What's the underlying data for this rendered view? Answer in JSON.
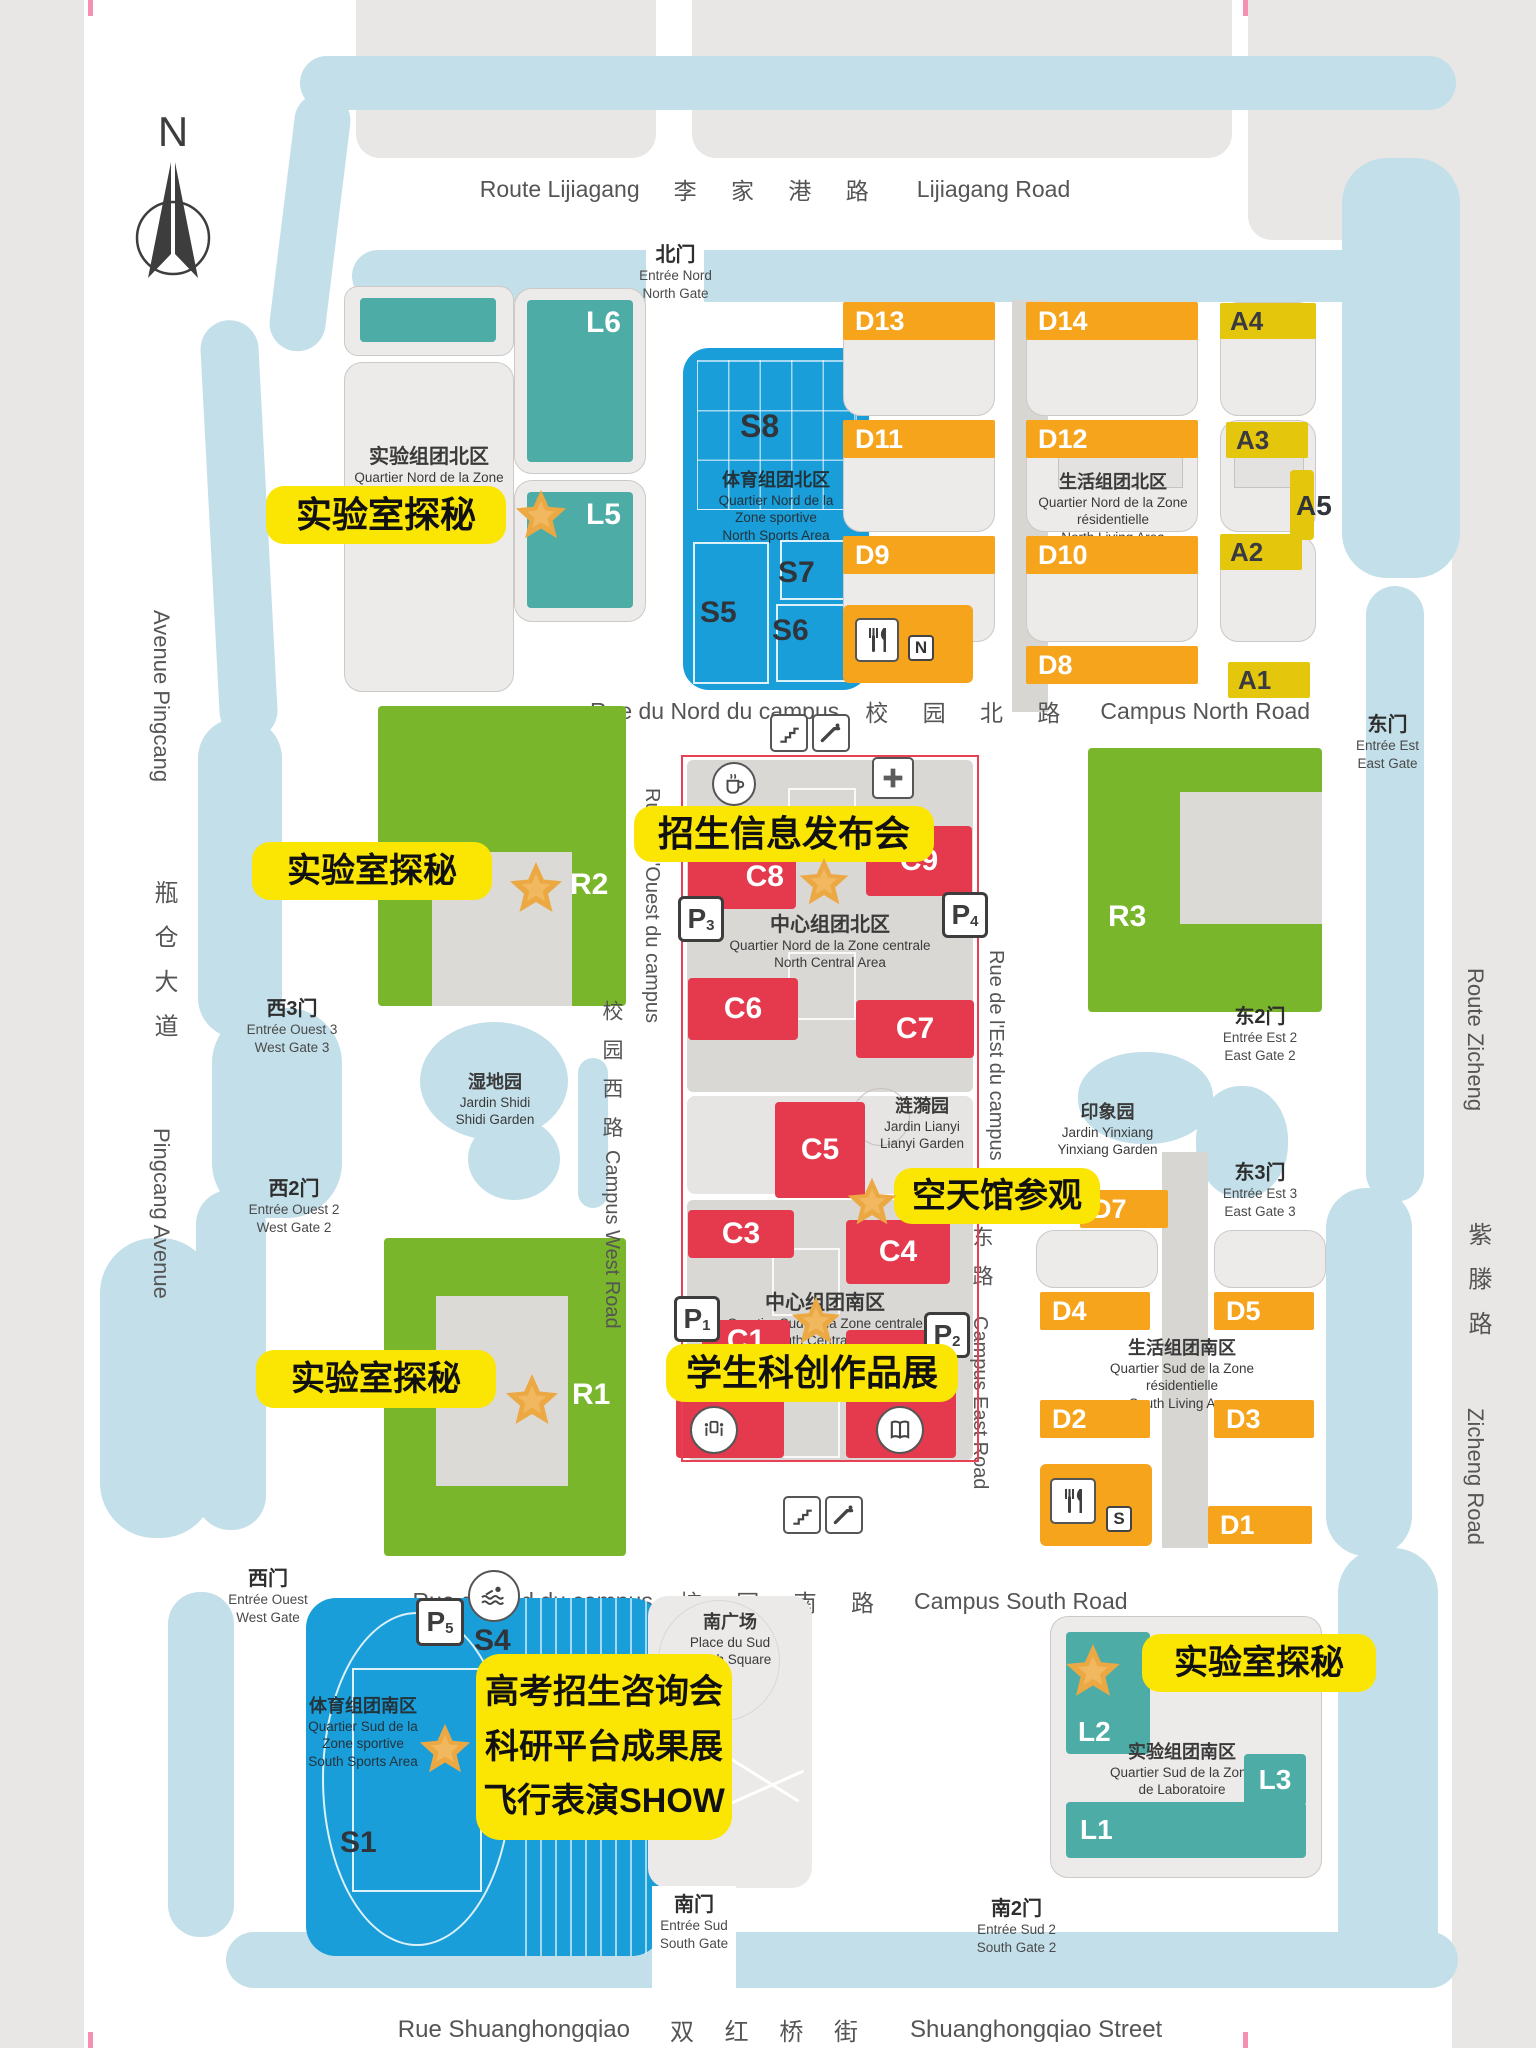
{
  "compass": {
    "label": "N"
  },
  "colors": {
    "water": "#c3dfe9",
    "sports_blue": "#1a9ed9",
    "lab_teal": "#4dada6",
    "residence_orange": "#f5a41c",
    "amenity_yellow": "#e4c60d",
    "central_red": "#e53a4e",
    "academic_green": "#79b62b",
    "event_yellow": "#fbe503",
    "star_orange": "#eca843"
  },
  "roads": {
    "lijiagang": {
      "fr": "Route Lijiagang",
      "zh": "李 家 港 路",
      "en": "Lijiagang Road"
    },
    "pingcang": {
      "fr": "Avenue Pingcang",
      "zh": "瓶仓大道",
      "en": "Pingcang Avenue"
    },
    "zicheng": {
      "fr": "Route Zicheng",
      "zh": "紫滕路",
      "en": "Zicheng Road"
    },
    "shuanghongqiao": {
      "fr": "Rue Shuanghongqiao",
      "zh": "双 红 桥 街",
      "en": "Shuanghongqiao Street"
    },
    "campus_north": {
      "fr": "Rue du Nord du campus",
      "zh": "校 园 北 路",
      "en": "Campus North Road"
    },
    "campus_south": {
      "fr": "Rue du Sud du campus",
      "zh": "校 园 南 路",
      "en": "Campus South Road"
    },
    "campus_west": {
      "fr": "Rue de l'Ouest du campus",
      "zh": "校园西路",
      "en": "Campus West Road"
    },
    "campus_east": {
      "fr": "Rue de l'Est du campus",
      "zh": "东路",
      "en": "Campus East Road"
    }
  },
  "gates": {
    "north": {
      "zh": "北门",
      "fr": "Entrée Nord",
      "en": "North Gate"
    },
    "east": {
      "zh": "东门",
      "fr": "Entrée Est",
      "en": "East Gate"
    },
    "east2": {
      "zh": "东2门",
      "fr": "Entrée Est 2",
      "en": "East Gate 2"
    },
    "east3": {
      "zh": "东3门",
      "fr": "Entrée Est 3",
      "en": "East Gate 3"
    },
    "west3": {
      "zh": "西3门",
      "fr": "Entrée Ouest 3",
      "en": "West Gate 3"
    },
    "west2": {
      "zh": "西2门",
      "fr": "Entrée Ouest 2",
      "en": "West Gate 2"
    },
    "west": {
      "zh": "西门",
      "fr": "Entrée Ouest",
      "en": "West Gate"
    },
    "south": {
      "zh": "南门",
      "fr": "Entrée Sud",
      "en": "South Gate"
    },
    "south2": {
      "zh": "南2门",
      "fr": "Entrée Sud 2",
      "en": "South Gate 2"
    }
  },
  "zones": {
    "lab_north": {
      "zh": "实验组团北区",
      "fr1": "Quartier Nord de la Zone",
      "fr2": "de Laboratoire"
    },
    "sports_north": {
      "zh": "体育组团北区",
      "fr1": "Quartier Nord de la",
      "fr2": "Zone sportive",
      "en": "North Sports Area"
    },
    "living_north": {
      "zh": "生活组团北区",
      "fr1": "Quartier Nord de la Zone",
      "fr2": "résidentielle",
      "en": "North Living Area"
    },
    "central_north": {
      "zh": "中心组团北区",
      "fr": "Quartier Nord de la Zone centrale",
      "en": "North Central Area"
    },
    "central_south": {
      "zh": "中心组团南区",
      "fr": "Quartier Sud de la Zone centrale",
      "en": "South Central Area"
    },
    "living_south": {
      "zh": "生活组团南区",
      "fr1": "Quartier Sud de la Zone",
      "fr2": "résidentielle",
      "en": "South Living Area"
    },
    "sports_south": {
      "zh": "体育组团南区",
      "fr1": "Quartier Sud de la",
      "fr2": "Zone sportive",
      "en": "South Sports Area"
    },
    "lab_south": {
      "zh": "实验组团南区",
      "fr1": "Quartier Sud de la Zone",
      "fr2": "de Laboratoire",
      "en": "South Laboratory Area"
    },
    "shidi": {
      "zh": "湿地园",
      "fr": "Jardin Shidi",
      "en": "Shidi Garden"
    },
    "lianyi": {
      "zh": "涟漪园",
      "fr": "Jardin Lianyi",
      "en": "Lianyi Garden"
    },
    "yinxiang": {
      "zh": "印象园",
      "fr": "Jardin Yinxiang",
      "en": "Yinxiang Garden"
    },
    "south_square": {
      "zh": "南广场",
      "fr": "Place du Sud",
      "en": "South Square"
    }
  },
  "buildings": {
    "L1": "L1",
    "L2": "L2",
    "L3": "L3",
    "L5": "L5",
    "L6": "L6",
    "S1": "S1",
    "S4": "S4",
    "S5": "S5",
    "S6": "S6",
    "S7": "S7",
    "S8": "S8",
    "A1": "A1",
    "A2": "A2",
    "A3": "A3",
    "A4": "A4",
    "A5": "A5",
    "C1": "C1",
    "C3": "C3",
    "C4": "C4",
    "C5": "C5",
    "C6": "C6",
    "C7": "C7",
    "C8": "C8",
    "C9": "C9",
    "D1": "D1",
    "D2": "D2",
    "D3": "D3",
    "D4": "D4",
    "D5": "D5",
    "D7": "D7",
    "D8": "D8",
    "D9": "D9",
    "D10": "D10",
    "D11": "D11",
    "D12": "D12",
    "D13": "D13",
    "D14": "D14",
    "R1": "R1",
    "R2": "R2",
    "R3": "R3"
  },
  "parking": {
    "P1": {
      "p": "P",
      "n": "1"
    },
    "P2": {
      "p": "P",
      "n": "2"
    },
    "P3": {
      "p": "P",
      "n": "3"
    },
    "P4": {
      "p": "P",
      "n": "4"
    },
    "P5": {
      "p": "P",
      "n": "5"
    }
  },
  "dining": {
    "north_badge": "N",
    "south_badge": "S"
  },
  "events": {
    "lab_tour_1": "实验室探秘",
    "lab_tour_2": "实验室探秘",
    "lab_tour_3": "实验室探秘",
    "lab_tour_4": "实验室探秘",
    "admission_info": "招生信息发布会",
    "aerospace_visit": "空天馆参观",
    "student_works": "学生科创作品展",
    "south_lines": [
      "高考招生咨询会",
      "科研平台成果展",
      "飞行表演SHOW"
    ]
  }
}
